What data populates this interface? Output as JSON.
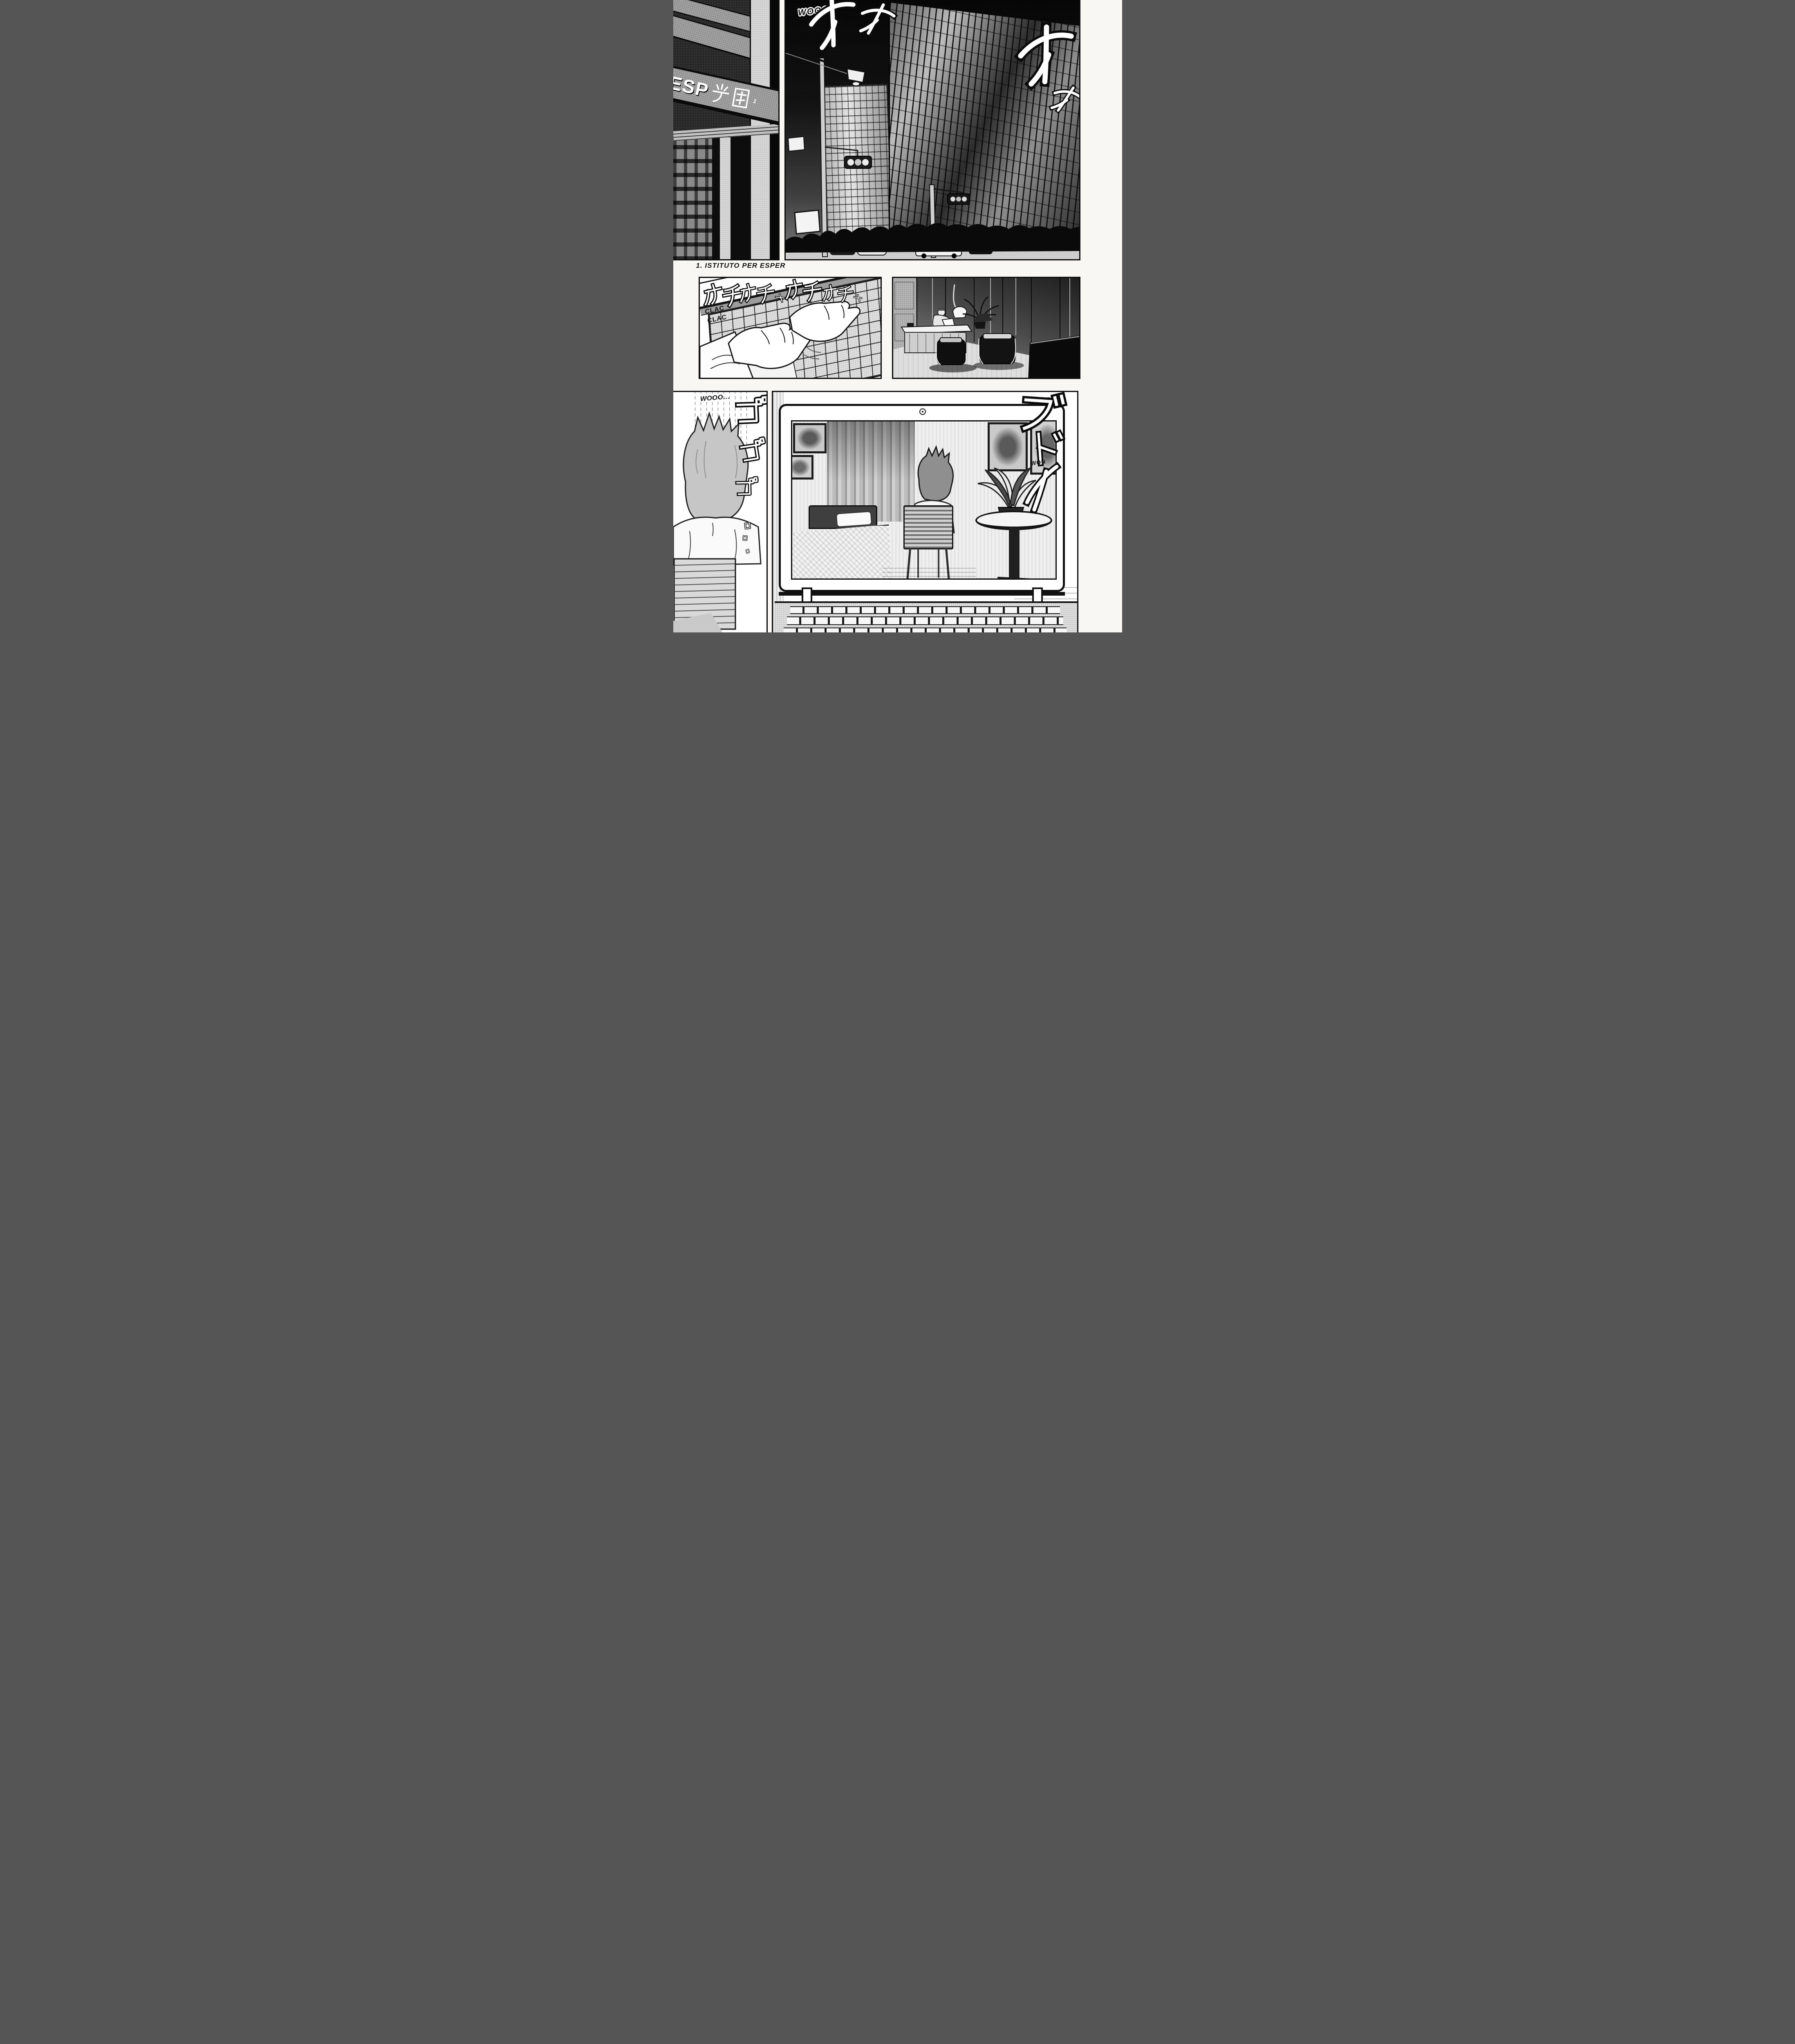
{
  "page": {
    "caption": "1. ISTITUTO PER ESPER"
  },
  "panel_building_sign": {
    "sign_latin": "ESP",
    "sign_kanji": "学園",
    "sign_note_marker": "1"
  },
  "panel_skyscraper": {
    "sfx_wind": "WOOO",
    "sfx_sparkles": [
      "オ",
      "オ",
      "オ",
      "オ"
    ]
  },
  "panel_typing": {
    "sfx_clack_line1": "CLAC",
    "sfx_clack_line2": "CLAC",
    "sfx_kana": [
      "カチ",
      "カチャ",
      "カチ",
      "カチャ"
    ]
  },
  "panel_sitting_back": {
    "sfx_wind": "WOOO...",
    "sfx_rumble": [
      "ゴ",
      "ゴ",
      "ゴ"
    ]
  },
  "panel_laptop_room": {
    "sfx_kana_top": "ブ",
    "sfx_kana_mid": "ド",
    "sfx_whir": "WON",
    "webcam_icon": "◎"
  }
}
